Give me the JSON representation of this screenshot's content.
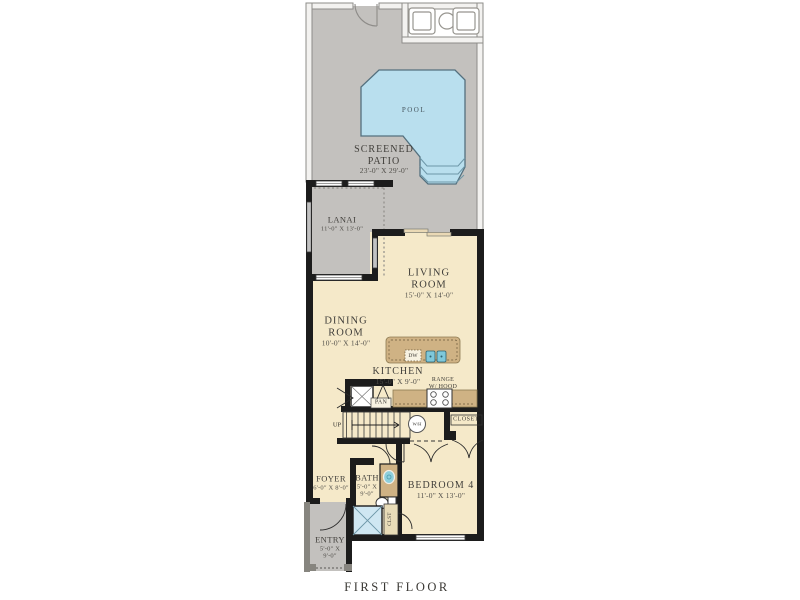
{
  "footer": {
    "label": "FIRST FLOOR"
  },
  "colors": {
    "patio_gray": "#c3c1be",
    "floor_cream": "#f5e9c9",
    "pool_blue": "#b9dfee",
    "cabinet_tan": "#cfb284",
    "wall_black": "#1c1c1c",
    "sink_teal": "#7fc8da"
  },
  "rooms": {
    "pool": {
      "label": "POOL"
    },
    "screened_patio": {
      "line1": "SCREENED",
      "line2": "PATIO",
      "dims": "23'-0\" X 29'-0\""
    },
    "lanai": {
      "label": "LANAI",
      "dims": "11'-0\" X 13'-0\""
    },
    "living_room": {
      "line1": "LIVING",
      "line2": "ROOM",
      "dims": "15'-0\" X 14'-0\""
    },
    "dining_room": {
      "line1": "DINING",
      "line2": "ROOM",
      "dims": "10'-0\" X 14'-0\""
    },
    "kitchen": {
      "label": "KITCHEN",
      "dims": "15'-0\" X 9'-0\""
    },
    "bedroom4": {
      "label": "BEDROOM 4",
      "dims": "11'-0\" X 13'-0\""
    },
    "bath": {
      "label": "BATH",
      "dims_line1": "5'-0\" X",
      "dims_line2": "9'-0\""
    },
    "foyer": {
      "label": "FOYER",
      "dims": "6'-0\" X 8'-0\""
    },
    "entry": {
      "label": "ENTRY",
      "dims_line1": "5'-0\" X",
      "dims_line2": "9'-0\""
    }
  },
  "fixtures": {
    "range": {
      "line1": "RANGE",
      "line2": "W/ HOOD"
    },
    "dishwasher": "DW",
    "pantry": "PAN",
    "closet": "CLOSET",
    "small_closet": "CLST",
    "stairs_direction": "UP",
    "water_heater": "W/H"
  }
}
